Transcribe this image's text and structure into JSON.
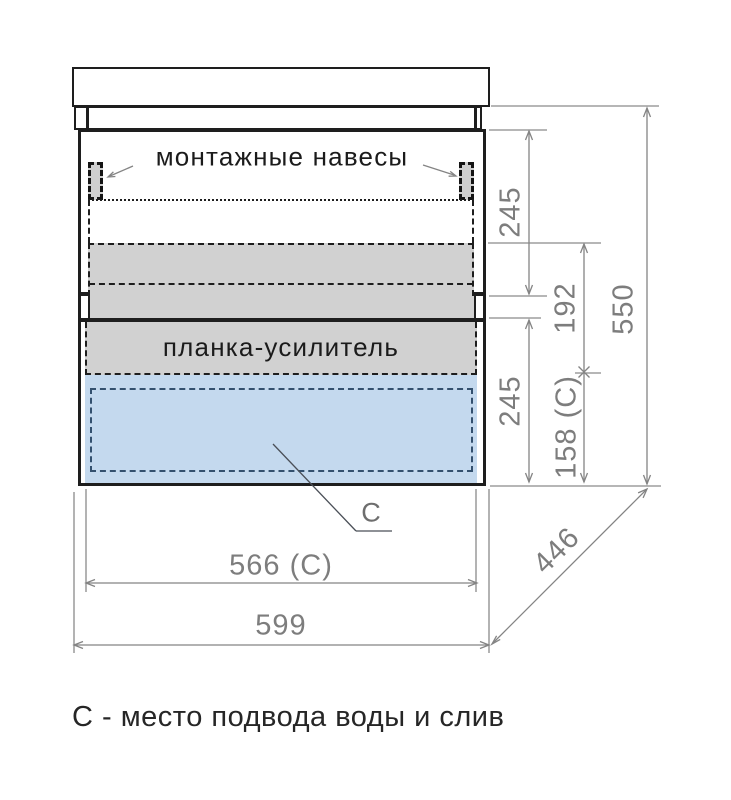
{
  "annotations": {
    "mounting_hangers": "монтажные навесы",
    "reinforcement_plank": "планка-усилитель",
    "c_marker": "C"
  },
  "dimensions": {
    "upper_section_height": "245",
    "rail_gap": "192",
    "lower_section_height": "245",
    "c_zone_height": "158 (C)",
    "overall_height": "550",
    "c_zone_width": "566 (C)",
    "overall_width": "599",
    "depth": "446"
  },
  "caption": "С - место подвода воды и слив",
  "colors": {
    "outline": "#1e1e1e",
    "dimension_lines": "#848484",
    "gray_fill": "#d1d1d1",
    "blue_fill": "#c4d9ee",
    "blue_dash": "#33506e"
  }
}
